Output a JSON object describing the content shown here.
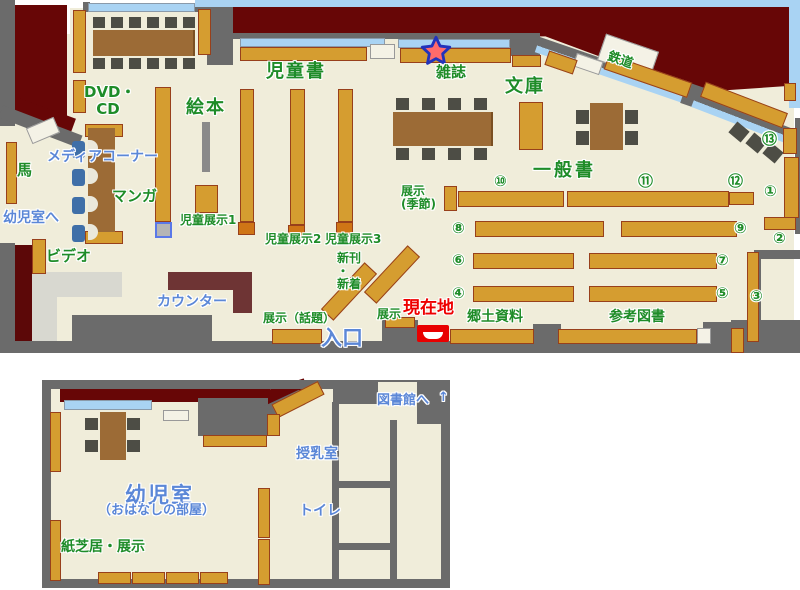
{
  "title": "library-floor-map",
  "palette": {
    "floor": "#f0edda",
    "outside": "#670606",
    "wall": "#6b6b6b",
    "shelf": "#d59d30",
    "shelf_border": "#98401b",
    "table": "#9c6b36",
    "chair": "#4d4d45",
    "window": "#a9d3f3",
    "sky": "#a9d3f3",
    "counter": "#6e3434",
    "green_label": "#1e8c28",
    "blue_label": "#5b87d7",
    "current_location_red": "#ee0000"
  },
  "markers": {
    "star": {
      "meaning": "star-marker",
      "fill": "#ff6b6b",
      "outline": "#2233bb",
      "x": 419,
      "y": 35
    },
    "current_location": {
      "label": "現在地",
      "x": 417,
      "y": 325
    }
  },
  "upper_map": {
    "labels": [
      {
        "id": "jidousho",
        "text": "児童書",
        "color": "g",
        "x": 266,
        "y": 62,
        "fs": 18,
        "ls": 2
      },
      {
        "id": "ehon",
        "text": "絵本",
        "color": "g",
        "x": 186,
        "y": 98,
        "fs": 18,
        "ls": 2
      },
      {
        "id": "dvd-cd",
        "text": "DVD・\nCD",
        "color": "g",
        "x": 84,
        "y": 84,
        "fs": 15,
        "w": 48,
        "ta": "center"
      },
      {
        "id": "media-corner",
        "text": "メディアコーナー",
        "color": "b",
        "x": 47,
        "y": 150,
        "fs": 14
      },
      {
        "id": "manga",
        "text": "マンガ",
        "color": "g",
        "x": 112,
        "y": 188,
        "fs": 15
      },
      {
        "id": "uma",
        "text": "馬",
        "color": "g",
        "x": 17,
        "y": 162,
        "fs": 15
      },
      {
        "id": "to-youjishitsu",
        "text": "幼児室へ",
        "color": "b",
        "x": 3,
        "y": 211,
        "fs": 14
      },
      {
        "id": "video",
        "text": "ビデオ",
        "color": "g",
        "x": 46,
        "y": 248,
        "fs": 15
      },
      {
        "id": "counter",
        "text": "カウンター",
        "color": "b",
        "x": 157,
        "y": 295,
        "fs": 14
      },
      {
        "id": "jidou-tenji1",
        "text": "児童展示1",
        "color": "g",
        "x": 180,
        "y": 214,
        "fs": 12
      },
      {
        "id": "jidou-tenji2",
        "text": "児童展示2",
        "color": "g",
        "x": 265,
        "y": 233,
        "fs": 12
      },
      {
        "id": "jidou-tenji3",
        "text": "児童展示3",
        "color": "g",
        "x": 325,
        "y": 233,
        "fs": 12
      },
      {
        "id": "shinkan-shinchaku",
        "text": "新刊\n ・\n  新着",
        "color": "g",
        "x": 337,
        "y": 252,
        "fs": 12
      },
      {
        "id": "tenji-wadai",
        "text": "展示（話題）",
        "color": "g",
        "x": 263,
        "y": 312,
        "fs": 12
      },
      {
        "id": "tenji-entrance",
        "text": "展示",
        "color": "g",
        "x": 377,
        "y": 308,
        "fs": 12
      },
      {
        "id": "tenji-kisetsu",
        "text": "展示\n(季節)",
        "color": "g",
        "x": 401,
        "y": 185,
        "fs": 12
      },
      {
        "id": "zasshi",
        "text": "雑誌",
        "color": "g",
        "x": 436,
        "y": 64,
        "fs": 15
      },
      {
        "id": "bunko",
        "text": "文庫",
        "color": "g",
        "x": 505,
        "y": 77,
        "fs": 18,
        "ls": 2
      },
      {
        "id": "tetsudou",
        "text": "鉄道",
        "color": "g",
        "x": 610,
        "y": 50,
        "fs": 13,
        "rot": 19
      },
      {
        "id": "ippansho",
        "text": "一般書",
        "color": "g",
        "x": 533,
        "y": 161,
        "fs": 18,
        "ls": 3
      },
      {
        "id": "kyoudo-shiryou",
        "text": "郷土資料",
        "color": "g",
        "x": 467,
        "y": 310,
        "fs": 14
      },
      {
        "id": "sankou-tosho",
        "text": "参考図書",
        "color": "g",
        "x": 609,
        "y": 310,
        "fs": 14
      },
      {
        "id": "genzaichi",
        "text": "現在地",
        "color": "r",
        "x": 403,
        "y": 299,
        "fs": 17
      },
      {
        "id": "iriguchi",
        "text": "入口",
        "color": "b",
        "x": 321,
        "y": 327,
        "fs": 21
      },
      {
        "id": "no10",
        "text": "⑩",
        "color": "g",
        "x": 494,
        "y": 173,
        "fs": 15
      },
      {
        "id": "no11",
        "text": "⑪",
        "color": "g",
        "x": 638,
        "y": 173,
        "fs": 15
      },
      {
        "id": "no12",
        "text": "⑫",
        "color": "g",
        "x": 728,
        "y": 173,
        "fs": 15
      },
      {
        "id": "no13",
        "text": "⑬",
        "color": "g",
        "x": 762,
        "y": 131,
        "fs": 15
      },
      {
        "id": "no1",
        "text": "①",
        "color": "g",
        "x": 764,
        "y": 183,
        "fs": 15
      },
      {
        "id": "no2",
        "text": "②",
        "color": "g",
        "x": 773,
        "y": 230,
        "fs": 15
      },
      {
        "id": "no3",
        "text": "③",
        "color": "g",
        "x": 750,
        "y": 288,
        "fs": 15
      },
      {
        "id": "no8",
        "text": "⑧",
        "color": "g",
        "x": 452,
        "y": 220,
        "fs": 15
      },
      {
        "id": "no9",
        "text": "⑨",
        "color": "g",
        "x": 734,
        "y": 220,
        "fs": 15
      },
      {
        "id": "no6",
        "text": "⑥",
        "color": "g",
        "x": 452,
        "y": 252,
        "fs": 15
      },
      {
        "id": "no7",
        "text": "⑦",
        "color": "g",
        "x": 716,
        "y": 252,
        "fs": 15
      },
      {
        "id": "no4",
        "text": "④",
        "color": "g",
        "x": 452,
        "y": 285,
        "fs": 15
      },
      {
        "id": "no5",
        "text": "⑤",
        "color": "g",
        "x": 716,
        "y": 285,
        "fs": 15
      }
    ]
  },
  "lower_map": {
    "labels": [
      {
        "id": "to-toshokan",
        "text": "図書館へ",
        "color": "b",
        "x": 377,
        "y": 394,
        "fs": 13
      },
      {
        "id": "to-toshokan-arrow",
        "text": "↑",
        "color": "b",
        "x": 438,
        "y": 391,
        "fs": 13
      },
      {
        "id": "jyunyuushitsu",
        "text": "授乳室",
        "color": "b",
        "x": 296,
        "y": 447,
        "fs": 14
      },
      {
        "id": "toilet",
        "text": "トイレ",
        "color": "b",
        "x": 299,
        "y": 504,
        "fs": 14
      },
      {
        "id": "youjishitsu",
        "text": "幼児室",
        "color": "b",
        "x": 125,
        "y": 484,
        "fs": 21,
        "ls": 2
      },
      {
        "id": "ohanashi-no-heya",
        "text": "（おはなしの部屋）",
        "color": "b",
        "x": 98,
        "y": 504,
        "fs": 13
      },
      {
        "id": "kamishibai-tenji",
        "text": "紙芝居・展示",
        "color": "g",
        "x": 61,
        "y": 540,
        "fs": 14
      }
    ]
  }
}
